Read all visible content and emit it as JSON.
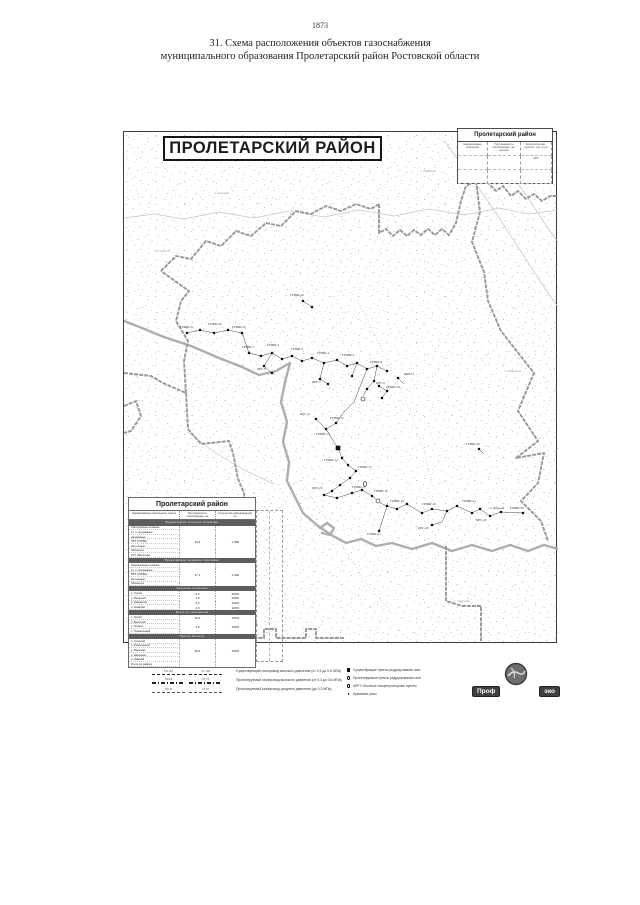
{
  "page": {
    "number": "1873",
    "title_line1": "31. Схема расположения объектов газоснабжения",
    "title_line2": "муниципального образования Пролетарский район Ростовской области"
  },
  "map": {
    "title": "ПРОЛЕТАРСКИЙ РАЙОН",
    "info_box": {
      "title": "Пролетарский район",
      "grid": [
        [
          "Наименование поселения",
          "Протяженность газопроводов, пог. метров",
          "Количество нас. пунктов, тыс. штук"
        ],
        [
          "",
          "",
          "20%"
        ],
        [
          "",
          "",
          "-"
        ]
      ]
    },
    "layers": [
      {
        "cls": "road",
        "lines": [
          "0,86 30,82 60,87 95,80 130,86 165,79 200,85 235,78 270,84 305,77 340,83 375,76 405,82 434,78",
          "320,9 345,42 370,78 396,118 420,155 434,175",
          "355,0 376,28 400,60 423,95 434,110",
          "64,300 90,320 120,338 150,352"
        ]
      },
      {
        "cls": "road dotted",
        "lines": [
          "233,168 252,205 270,243 287,281 300,319 309,357",
          "177,349 200,384 222,419 244,454 267,479"
        ]
      },
      {
        "cls": "river",
        "lines": [
          "0,189 18,196 40,205 67,214 95,226 118,235 135,243 152,239 166,231 161,250 157,270 163,290 159,310 165,330 163,349 171,365 179,381 194,394 209,404 222,411 237,407 252,414 268,411 288,417 308,411 328,419 348,413 368,419 386,413 404,419 420,413 434,417",
          "196,396 203,391 210,396 206,403 198,401"
        ]
      },
      {
        "cls": "boundary",
        "lines": [
          "37,139 52,124 67,127 82,109 97,114 112,99 127,104 142,91 157,94 172,79 187,82 202,74 217,79 232,72 247,77 255,72",
          "255,72 255,101 262,97 269,104 276,98 283,104 290,98 297,103 304,97 311,103 318,97 325,103 332,91 337,69 342,54 352,49 364,51 372,59 379,54 387,64 394,59 402,67 410,62 418,69 426,64 434,64",
          "0,241 27,244 39,251 62,261 64,297 77,312 105,309 109,321 114,347 120,361 123,389 122,429 119,459 127,479 133,494",
          "62,261 60,229 64,209 52,189 57,169 65,159 37,139",
          "0,274 12,269 17,284 7,299 0,301",
          "352,49 356,80 348,110 360,140 364,169 377,199 410,241 394,279 414,309 392,326 420,321 414,351 397,369 417,389 424,409",
          "322,414 322,449 322,469 338,474 357,474 357,509",
          "37,489 37,497 52,497 52,506 77,506 77,497 92,497 92,506 140,506 140,497 152,497 152,506 182,506 182,497 192,497 192,506 220,506"
        ]
      },
      {
        "cls": "net",
        "lines": [
          "63,201 76,198 90,201 104,198 118,201 125,221",
          "125,221 137,224 148,221 158,227 168,224 178,229 188,226 200,231 213,228 223,234 233,231 243,237 253,234 263,239",
          "148,221 140,234 148,241",
          "200,231 196,247 204,252",
          "233,231 228,244",
          "253,234 250,249 243,257 239,264",
          "243,237 230,270 220,280 212,291",
          "192,287 202,297 212,291",
          "202,297 210,310 214,316 218,326",
          "218,326 224,333 232,339 226,346 216,353 208,359 200,363 213,366 228,361 238,358 248,364 254,369",
          "256,371 263,374 273,377 283,372 298,381 308,377 323,379 333,374 348,381 356,377 366,384 377,380 399,381",
          "323,379 318,390 308,393",
          "263,374 255,399",
          "255,254 263,259 258,266",
          "179,169 188,175",
          "274,246 280,252",
          "355,317 360,322"
        ]
      }
    ],
    "facilities": [
      {
        "t": "sq",
        "x": 63,
        "y": 201
      },
      {
        "t": "sq",
        "x": 76,
        "y": 198
      },
      {
        "t": "sq",
        "x": 90,
        "y": 201
      },
      {
        "t": "sq",
        "x": 104,
        "y": 198
      },
      {
        "t": "sq",
        "x": 118,
        "y": 201
      },
      {
        "t": "sq",
        "x": 125,
        "y": 221
      },
      {
        "t": "sq",
        "x": 137,
        "y": 224
      },
      {
        "t": "sq",
        "x": 148,
        "y": 221
      },
      {
        "t": "sq",
        "x": 158,
        "y": 227
      },
      {
        "t": "sq",
        "x": 168,
        "y": 224
      },
      {
        "t": "sq",
        "x": 178,
        "y": 229
      },
      {
        "t": "sq",
        "x": 188,
        "y": 226
      },
      {
        "t": "sq",
        "x": 200,
        "y": 231
      },
      {
        "t": "sq",
        "x": 213,
        "y": 228
      },
      {
        "t": "sq",
        "x": 223,
        "y": 234
      },
      {
        "t": "sq",
        "x": 233,
        "y": 231
      },
      {
        "t": "sq",
        "x": 243,
        "y": 237
      },
      {
        "t": "sq",
        "x": 253,
        "y": 234
      },
      {
        "t": "sq",
        "x": 263,
        "y": 239
      },
      {
        "t": "sq",
        "x": 140,
        "y": 234
      },
      {
        "t": "sq",
        "x": 148,
        "y": 241
      },
      {
        "t": "sq",
        "x": 196,
        "y": 247
      },
      {
        "t": "sq",
        "x": 204,
        "y": 252
      },
      {
        "t": "sq",
        "x": 228,
        "y": 244
      },
      {
        "t": "sq",
        "x": 250,
        "y": 249
      },
      {
        "t": "sq",
        "x": 243,
        "y": 257
      },
      {
        "t": "ci",
        "x": 239,
        "y": 267
      },
      {
        "t": "sq",
        "x": 192,
        "y": 287
      },
      {
        "t": "sq",
        "x": 202,
        "y": 297
      },
      {
        "t": "sq",
        "x": 212,
        "y": 291
      },
      {
        "t": "bsq",
        "x": 214,
        "y": 316
      },
      {
        "t": "sq",
        "x": 218,
        "y": 326
      },
      {
        "t": "sq",
        "x": 224,
        "y": 333
      },
      {
        "t": "sq",
        "x": 232,
        "y": 339
      },
      {
        "t": "sq",
        "x": 226,
        "y": 346
      },
      {
        "t": "sq",
        "x": 216,
        "y": 353
      },
      {
        "t": "sq",
        "x": 208,
        "y": 359
      },
      {
        "t": "sq",
        "x": 200,
        "y": 363
      },
      {
        "t": "sq",
        "x": 213,
        "y": 366
      },
      {
        "t": "sq",
        "x": 228,
        "y": 361
      },
      {
        "t": "sq",
        "x": 238,
        "y": 358
      },
      {
        "t": "sq",
        "x": 248,
        "y": 364
      },
      {
        "t": "cy",
        "x": 241,
        "y": 352
      },
      {
        "t": "sq",
        "x": 255,
        "y": 254
      },
      {
        "t": "sq",
        "x": 263,
        "y": 259
      },
      {
        "t": "sq",
        "x": 258,
        "y": 266
      },
      {
        "t": "ci",
        "x": 254,
        "y": 369
      },
      {
        "t": "sq",
        "x": 263,
        "y": 374
      },
      {
        "t": "sq",
        "x": 273,
        "y": 377
      },
      {
        "t": "sq",
        "x": 283,
        "y": 372
      },
      {
        "t": "sq",
        "x": 298,
        "y": 381
      },
      {
        "t": "sq",
        "x": 308,
        "y": 377
      },
      {
        "t": "sq",
        "x": 323,
        "y": 379
      },
      {
        "t": "sq",
        "x": 333,
        "y": 374
      },
      {
        "t": "sq",
        "x": 348,
        "y": 381
      },
      {
        "t": "sq",
        "x": 356,
        "y": 377
      },
      {
        "t": "sq",
        "x": 366,
        "y": 384
      },
      {
        "t": "sq",
        "x": 377,
        "y": 380
      },
      {
        "t": "sq",
        "x": 399,
        "y": 381
      },
      {
        "t": "sq",
        "x": 308,
        "y": 393
      },
      {
        "t": "sq",
        "x": 255,
        "y": 399
      },
      {
        "t": "sq",
        "x": 179,
        "y": 169
      },
      {
        "t": "sq",
        "x": 188,
        "y": 175
      },
      {
        "t": "sq",
        "x": 274,
        "y": 246
      },
      {
        "t": "sq",
        "x": 355,
        "y": 317
      }
    ],
    "labels": [
      {
        "x": 56,
        "y": 196,
        "s": "ГРПШ-21"
      },
      {
        "x": 84,
        "y": 193,
        "s": "ГРПШ-22"
      },
      {
        "x": 108,
        "y": 196,
        "s": "ГРПШ-23"
      },
      {
        "x": 118,
        "y": 216,
        "s": "ГРПШ-1"
      },
      {
        "x": 143,
        "y": 214,
        "s": "ГРПШ-2"
      },
      {
        "x": 167,
        "y": 218,
        "s": "ГРПШ-3"
      },
      {
        "x": 193,
        "y": 222,
        "s": "ГРПШ-4"
      },
      {
        "x": 218,
        "y": 224,
        "s": "ГРПШ-5"
      },
      {
        "x": 133,
        "y": 238,
        "s": "ПРГ-6"
      },
      {
        "x": 188,
        "y": 251,
        "s": "ПРГ-7"
      },
      {
        "x": 246,
        "y": 231,
        "s": "ГРПШ-8"
      },
      {
        "x": 252,
        "y": 252,
        "s": "ПРГ-9"
      },
      {
        "x": 262,
        "y": 256,
        "s": "ГРПШ-10"
      },
      {
        "x": 176,
        "y": 283,
        "s": "ПРГ-11"
      },
      {
        "x": 206,
        "y": 287,
        "s": "ГРПШ-12"
      },
      {
        "x": 192,
        "y": 303,
        "s": "ГРПШ-13"
      },
      {
        "x": 200,
        "y": 329,
        "s": "ГРПШ-14"
      },
      {
        "x": 234,
        "y": 336,
        "s": "ГРПШ-15"
      },
      {
        "x": 188,
        "y": 357,
        "s": "ПРГ-16"
      },
      {
        "x": 228,
        "y": 356,
        "s": "ГРПШ-17"
      },
      {
        "x": 250,
        "y": 360,
        "s": "ГРПШ-18"
      },
      {
        "x": 266,
        "y": 370,
        "s": "ГРПШ-19"
      },
      {
        "x": 298,
        "y": 373,
        "s": "ГРПШ-20"
      },
      {
        "x": 338,
        "y": 370,
        "s": "ГРПШ-24"
      },
      {
        "x": 366,
        "y": 377,
        "s": "х. Дальний"
      },
      {
        "x": 352,
        "y": 389,
        "s": "ПРГ-25"
      },
      {
        "x": 294,
        "y": 397,
        "s": "ПРГ-26"
      },
      {
        "x": 243,
        "y": 403,
        "s": "ГРПШ-27"
      },
      {
        "x": 386,
        "y": 377,
        "s": "ГРПШ-30"
      },
      {
        "x": 166,
        "y": 164,
        "s": "ГРПШ-28"
      },
      {
        "x": 280,
        "y": 243,
        "s": "ШРП-2"
      },
      {
        "x": 342,
        "y": 313,
        "s": "ГРПШ-29"
      },
      {
        "x": 30,
        "y": 120,
        "s": "х. Степной",
        "g": 1
      },
      {
        "x": 296,
        "y": 40,
        "s": "х. Верхний",
        "g": 1
      },
      {
        "x": 90,
        "y": 62,
        "s": "п. Ковалёв",
        "g": 1
      },
      {
        "x": 380,
        "y": 240,
        "s": "х. Камышев",
        "g": 1
      },
      {
        "x": 60,
        "y": 430,
        "s": "х. Тихий",
        "g": 1
      },
      {
        "x": 330,
        "y": 470,
        "s": "х. Нижний",
        "g": 1
      }
    ]
  },
  "left_table": {
    "title": "Пролетарский район",
    "headers": [
      "Наименование населенного пункта",
      "Протяженность газопроводов, км",
      "Количество домовладений, шт."
    ],
    "rows": [
      {
        "b": "Будённовское сельское поселение"
      },
      {
        "l": "Газопроводы сетевые"
      },
      {
        "l": "в т.ч. подземные"
      },
      {
        "l": "надземные"
      },
      {
        "l": "ПРГ (ГРПШ)",
        "v1": "14,6",
        "v2": "1 080"
      },
      {
        "l": "Котельные"
      },
      {
        "l": "Абоненты"
      },
      {
        "l": "СУГ (баллоны)"
      },
      {
        "b": "Пролетарское городское поселение"
      },
      {
        "l": "Газопроводы сетевые"
      },
      {
        "l": "в т.ч. подземные"
      },
      {
        "l": "ПРГ (ГРПШ)",
        "v1": "17,1",
        "v2": "4 000"
      },
      {
        "l": "Котельные"
      },
      {
        "l": "Абоненты"
      },
      {
        "b": "Сельские поселения"
      },
      {
        "l": "х. Сухой",
        "v1": "0,2",
        "v2": "100%"
      },
      {
        "l": "х. Весёлый",
        "v1": "1,5",
        "v2": "100%"
      },
      {
        "l": "х. Найдёнов",
        "v1": "3,4",
        "v2": "100%"
      },
      {
        "l": "х. Ковалёв",
        "v1": "4,6",
        "v2": "100%"
      },
      {
        "b": "Итого по поселениям"
      },
      {
        "l": "х. Тихий",
        "v1": "10,2",
        "v2": "100%"
      },
      {
        "l": "х. Быстрый"
      },
      {
        "l": "х. Огонёк",
        "v1": "4,5",
        "v2": "100%"
      },
      {
        "l": "х. Привольный"
      },
      {
        "b": "Прочие объекты"
      },
      {
        "l": "х. Степной"
      },
      {
        "l": "х. Раздольный"
      },
      {
        "l": "х. Верхний",
        "v1": "45,6",
        "v2": "100%"
      },
      {
        "l": "х. Широкий"
      },
      {
        "l": "х. Нижний"
      },
      {
        "l": "Итого по району"
      }
    ]
  },
  "legend": {
    "lines": [
      {
        "tag1": "ПЭ 110",
        "tag2": "СТ 108",
        "desc": "Существующий газопровод высокого давления (от 0,3 до 0,6 МПа)"
      },
      {
        "tag1": "ПЭ 63",
        "tag2": "СТ 76",
        "desc": "Проектируемый газопровод высокого давления (от 0,3 до 0,6 МПа)"
      },
      {
        "tag1": "ПЭ 32",
        "tag2": "СТ 57",
        "desc": "Проектируемый газопровод среднего давления (до 0,3 МПа)"
      }
    ],
    "symbols": [
      {
        "t": "sq",
        "label": "Существующие пункты редуцирования газа"
      },
      {
        "t": "ci",
        "label": "Проектируемые пункты редуцирования газа"
      },
      {
        "t": "cy",
        "label": "ШРП / блочные газорегуляторные пункты"
      },
      {
        "t": "dt",
        "label": "Крановые узлы"
      }
    ]
  },
  "logo": {
    "left": "Проф",
    "right": "эко"
  }
}
